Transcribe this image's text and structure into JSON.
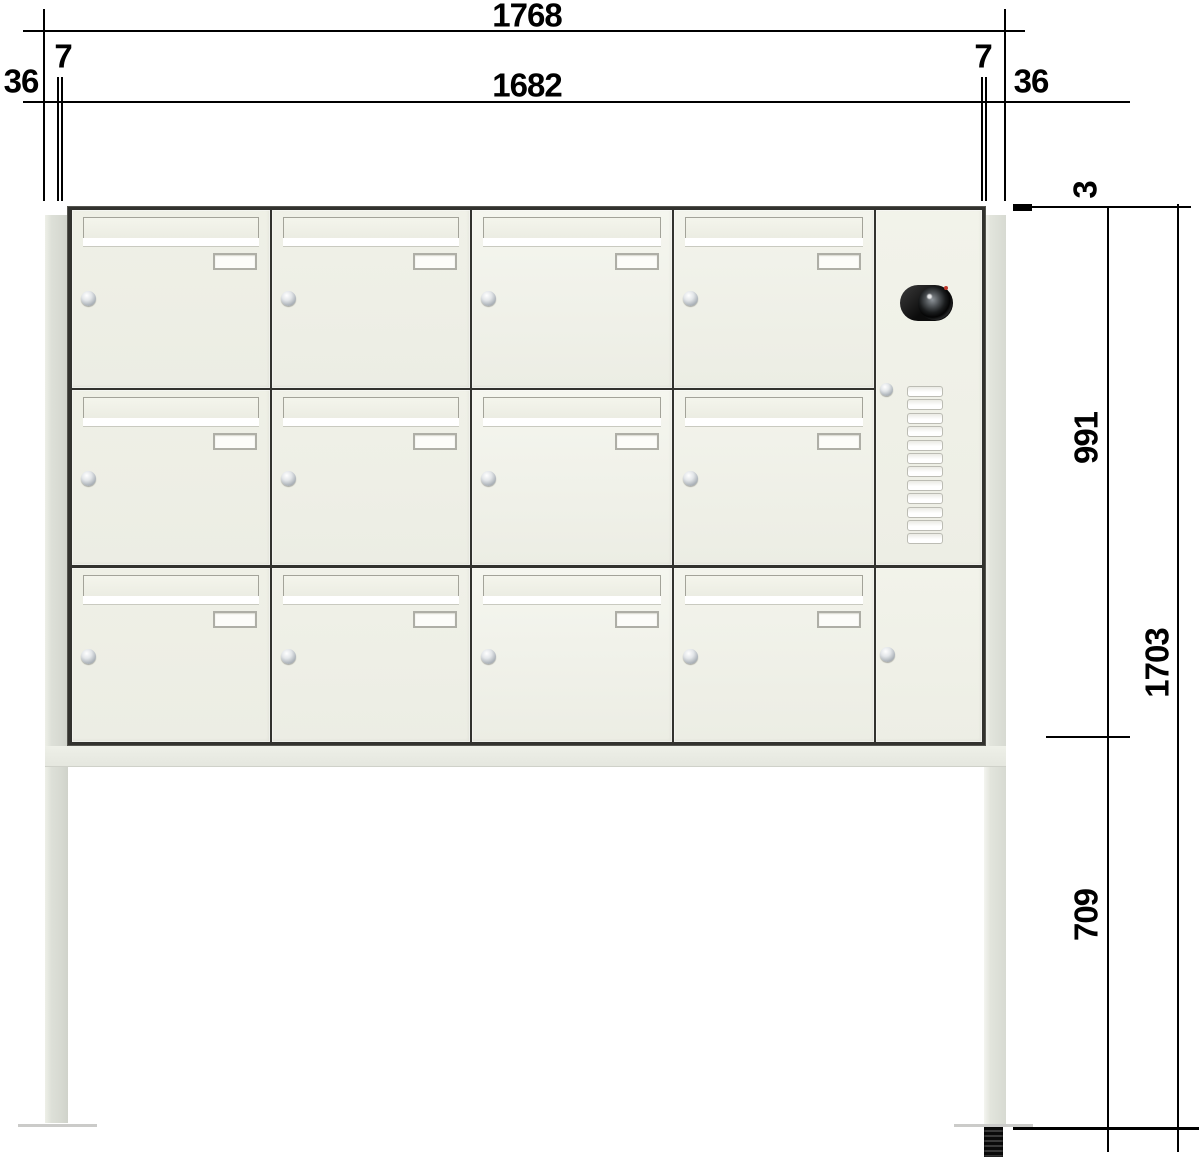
{
  "drawing": {
    "title": "Free-standing letterbox bank with intercom — front view technical drawing",
    "unit": "mm"
  },
  "dimensions_mm": {
    "top": {
      "overall_width": "1768",
      "body_width": "1682",
      "offset_left": "7",
      "offset_right": "7",
      "side_left": "36",
      "side_right": "36"
    },
    "right": {
      "top_gap": "3",
      "cabinet_height": "991",
      "stand_height": "709",
      "total_height": "1703"
    }
  },
  "cabinet": {
    "rows": 3,
    "mailbox_columns": 4,
    "mailbox_count": 12,
    "mailbox_parts": [
      "letter-flap",
      "name-plate",
      "cylinder-lock"
    ],
    "intercom": {
      "camera": true,
      "call_button_count": 12,
      "service_lock": true,
      "bottom_door_lock": true
    }
  },
  "stand": {
    "legs": 2,
    "crossbar": true,
    "anchor_bolt": true
  },
  "colors": {
    "door_face": "#f0f1e8",
    "door_face_bright": "#f5f6ef",
    "frame": "#32322e",
    "leg": "#dcded6",
    "dimension_lines": "#000000",
    "camera_body": "#111111",
    "ground_line": "#cbcbc9"
  }
}
